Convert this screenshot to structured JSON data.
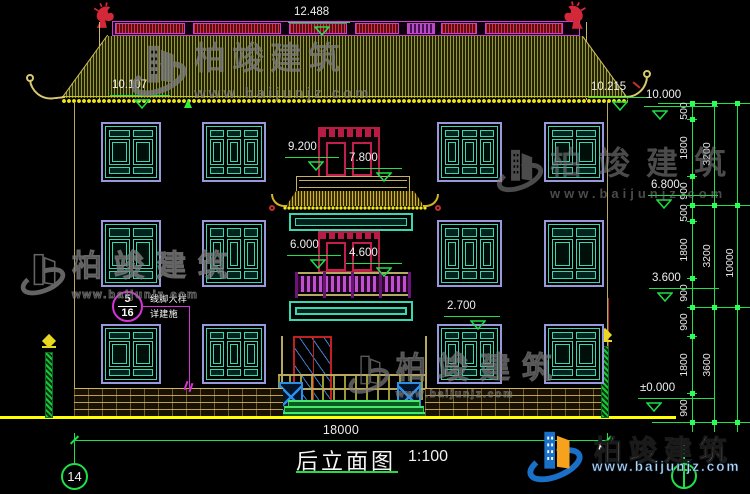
{
  "drawing": {
    "title": "后立面图",
    "scale": "1:100",
    "sheet_no": "14",
    "total_width": "18000",
    "elevations": {
      "e12488": "12.488",
      "e10215": "10.215",
      "e10107": "10.107",
      "e10000": "10.000",
      "e9200": "9.200",
      "e7800": "7.800",
      "e6800": "6.800",
      "e6000": "6.000",
      "e4600": "4.600",
      "e3600": "3.600",
      "e2700": "2.700",
      "e0000": "±0.000"
    },
    "chain": {
      "tier1": [
        "500",
        "1800",
        "900",
        "500",
        "1800",
        "900",
        "900",
        "1800",
        "900"
      ],
      "tier2": [
        "3200",
        "3200",
        "3600"
      ],
      "tier3": [
        "10000"
      ]
    },
    "callout": {
      "num_top": "5",
      "num_bottom": "16",
      "text_top": "线脚大样",
      "text_bottom": "详建施"
    }
  },
  "watermark": {
    "brand": "柏竣建筑",
    "url": "www.baijunjz.com"
  },
  "brand_logo": {
    "brand": "柏竣建筑",
    "url": "www.baijunjz.com"
  },
  "colors": {
    "background": "#000000",
    "dimension_green": "#1ee048",
    "roof_olive": "#8a8a26",
    "eave_yellow": "#e8e81a",
    "ridge_magenta": "#d040d0",
    "ridge_red": "#e22e40",
    "window_frame_purple": "#9898dc",
    "window_teal": "#35d8b0",
    "tower_crimson": "#b81c44",
    "railing_purple": "#c050d0",
    "ground_yellow": "#ffff00",
    "logo_blue": "#1a6fc9",
    "logo_orange": "#f6a21d"
  }
}
